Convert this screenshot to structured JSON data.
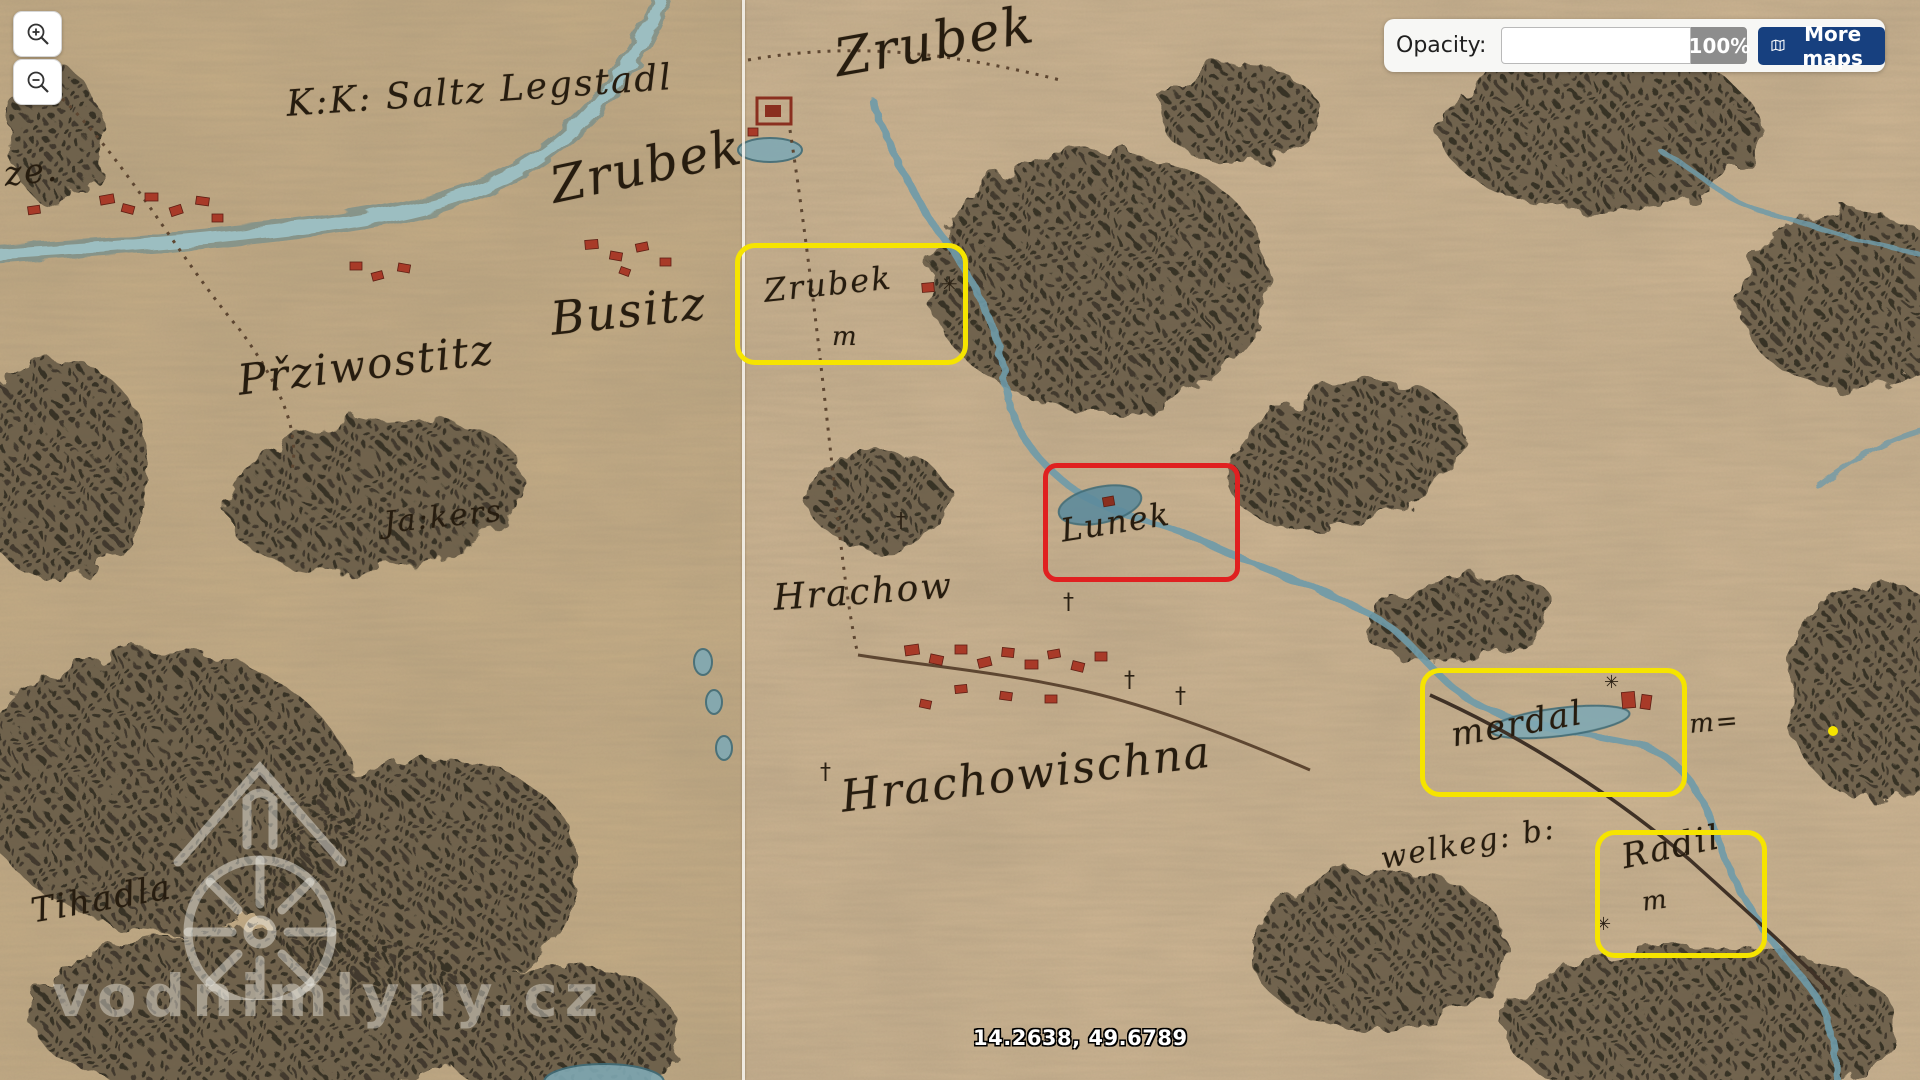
{
  "ui": {
    "zoom_in_icon": "magnifier-plus-icon",
    "zoom_out_icon": "magnifier-minus-icon",
    "opacity": {
      "label": "Opacity:",
      "value": "100%"
    },
    "more_maps": {
      "label": "More maps",
      "icon": "map-icon"
    },
    "coordinates": "14.2638, 49.6789",
    "watermark": "vodnimlyny.cz",
    "watermark_logo": "watermill-logo"
  },
  "colors": {
    "highlight_yellow": "#f6e400",
    "highlight_red": "#e02020",
    "more_maps_button": "#17407f",
    "opacity_badge": "#8d8d8d",
    "map_paper_left": "#c3ab85",
    "map_paper_right": "#cbb391"
  },
  "map": {
    "labels": [
      {
        "text": "ze.",
        "x": 2,
        "y": 155,
        "fs": 34,
        "rot": -6
      },
      {
        "text": "K:K: Saltz Legstadl",
        "x": 285,
        "y": 84,
        "fs": 36,
        "rot": -4
      },
      {
        "text": "Zrubek",
        "x": 545,
        "y": 158,
        "fs": 50,
        "rot": -12
      },
      {
        "text": "Busitz",
        "x": 548,
        "y": 292,
        "fs": 46,
        "rot": -6
      },
      {
        "text": "Přziwostitz",
        "x": 235,
        "y": 356,
        "fs": 42,
        "rot": -7
      },
      {
        "text": "Ja:kers",
        "x": 382,
        "y": 506,
        "fs": 30,
        "rot": -6
      },
      {
        "text": "Tihadla",
        "x": 28,
        "y": 892,
        "fs": 34,
        "rot": -10
      },
      {
        "text": "Zrubek",
        "x": 830,
        "y": 30,
        "fs": 52,
        "rot": -10
      },
      {
        "text": "Zrubek",
        "x": 762,
        "y": 272,
        "fs": 32,
        "rot": -6
      },
      {
        "text": "m",
        "x": 832,
        "y": 322,
        "fs": 26,
        "rot": 0
      },
      {
        "text": "Hrachow",
        "x": 772,
        "y": 578,
        "fs": 36,
        "rot": -4
      },
      {
        "text": "Hrachowischna",
        "x": 838,
        "y": 772,
        "fs": 44,
        "rot": -7
      },
      {
        "text": "Lunek",
        "x": 1058,
        "y": 512,
        "fs": 32,
        "rot": -9
      },
      {
        "text": "merdal",
        "x": 1448,
        "y": 716,
        "fs": 34,
        "rot": -10
      },
      {
        "text": "m=",
        "x": 1688,
        "y": 710,
        "fs": 26,
        "rot": -5
      },
      {
        "text": "welkeg: b:",
        "x": 1378,
        "y": 842,
        "fs": 30,
        "rot": -10
      },
      {
        "text": "Radil",
        "x": 1618,
        "y": 838,
        "fs": 34,
        "rot": -12
      },
      {
        "text": "m",
        "x": 1640,
        "y": 888,
        "fs": 26,
        "rot": -8
      }
    ],
    "features": [
      {
        "type": "mill-wheel",
        "glyph": "✳",
        "x": 941,
        "y": 272,
        "fs": 20
      },
      {
        "type": "mill-wheel",
        "glyph": "✳",
        "x": 1604,
        "y": 672,
        "fs": 18
      },
      {
        "type": "mill-wheel",
        "glyph": "✳",
        "x": 1596,
        "y": 914,
        "fs": 18
      },
      {
        "type": "cross",
        "glyph": "†",
        "x": 1063,
        "y": 590,
        "fs": 22
      },
      {
        "type": "cross",
        "glyph": "†",
        "x": 1124,
        "y": 668,
        "fs": 22
      },
      {
        "type": "cross",
        "glyph": "†",
        "x": 1175,
        "y": 684,
        "fs": 22
      },
      {
        "type": "cross",
        "glyph": "†",
        "x": 820,
        "y": 760,
        "fs": 22
      },
      {
        "type": "cross",
        "glyph": "†",
        "x": 896,
        "y": 508,
        "fs": 20
      }
    ]
  },
  "annotations": {
    "yellow_boxes": [
      {
        "x": 735,
        "y": 243,
        "w": 223,
        "h": 112
      },
      {
        "x": 1420,
        "y": 668,
        "w": 257,
        "h": 119
      },
      {
        "x": 1595,
        "y": 830,
        "w": 162,
        "h": 118
      }
    ],
    "red_boxes": [
      {
        "x": 1043,
        "y": 463,
        "w": 187,
        "h": 109
      }
    ],
    "dots": [
      {
        "x": 1833,
        "y": 731,
        "r": 5
      }
    ]
  }
}
